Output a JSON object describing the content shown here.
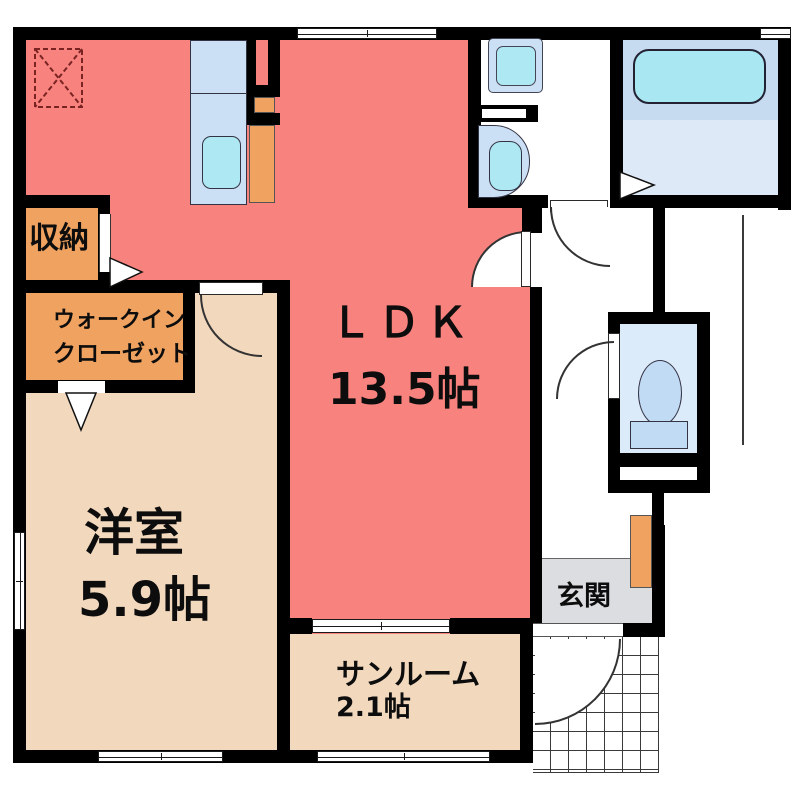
{
  "floorplan": {
    "title": "1LDK apartment floor plan",
    "rooms": {
      "ldk": {
        "label": "ＬＤＫ",
        "size": "13.5帖"
      },
      "western_room": {
        "label": "洋室",
        "size": "5.9帖"
      },
      "sunroom": {
        "label": "サンルーム",
        "size": "2.1帖"
      },
      "storage": {
        "label": "収納"
      },
      "walk_in_closet": {
        "label_line1": "ウォークイン",
        "label_line2": "クローゼット"
      },
      "entrance": {
        "label": "玄関"
      }
    },
    "fixtures": [
      "refrigerator-space",
      "kitchen-counter",
      "kitchen-sink",
      "washing-machine-pan",
      "washbasin",
      "bathtub",
      "bath-folding-door",
      "toilet",
      "shoe-cabinet",
      "entrance-porch-tiles",
      "door-swing-arcs",
      "sliding-windows"
    ],
    "colors": {
      "wall": "#000000",
      "ldk_red": "#F8827D",
      "room_beige": "#F2D8BD",
      "closet_orange": "#F0A360",
      "entrance_gray": "#DCDDE0",
      "fixture_blue": "#CBE0F5",
      "fixture_cyan": "#AEE9F3",
      "bath_upper_blue": "#C6DBF0",
      "bath_lower_blue": "#DDE9F6",
      "toilet_room_blue": "#DCEBFA",
      "toilet_fixture_blue": "#C2DBF5"
    }
  }
}
